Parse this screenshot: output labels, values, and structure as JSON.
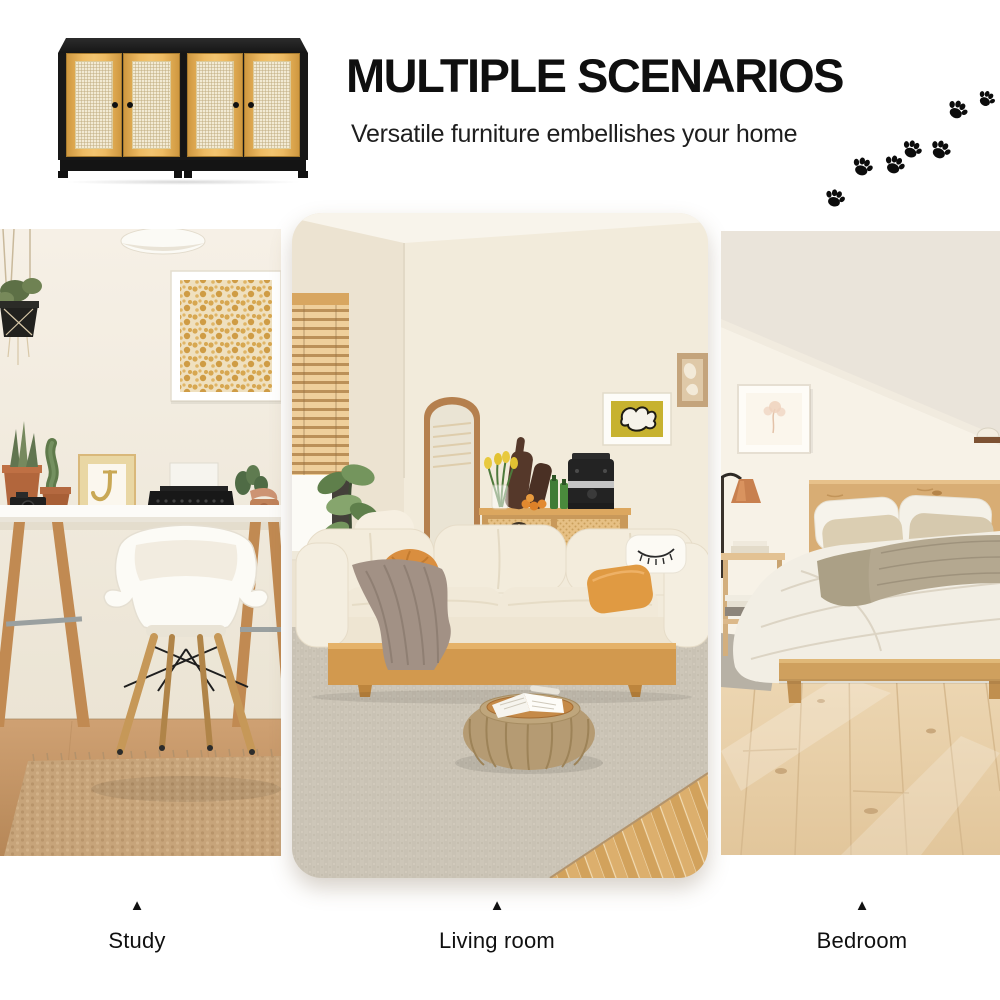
{
  "header": {
    "title": "MULTIPLE SCENARIOS",
    "subtitle": "Versatile furniture embellishes your home"
  },
  "scenes": [
    {
      "id": "study",
      "label": "Study",
      "marker": "▲"
    },
    {
      "id": "living-room",
      "label": "Living room",
      "marker": "▲"
    },
    {
      "id": "bedroom",
      "label": "Bedroom",
      "marker": "▲"
    }
  ],
  "icons": {
    "paw_print": "paw-print-icon",
    "triangle_marker": "triangle-up-icon"
  },
  "colors": {
    "background": "#ffffff",
    "heading_text": "#0f0f0f",
    "paw_black": "#0c0c0c",
    "cabinet_black": "#181818",
    "cabinet_wood": "#eebb63",
    "cabinet_rattan_panel": "#f2ead4",
    "wall_cream": "#f1ead9",
    "sofa_cream": "#f1e9d8",
    "wood_accent": "#d2994e"
  }
}
